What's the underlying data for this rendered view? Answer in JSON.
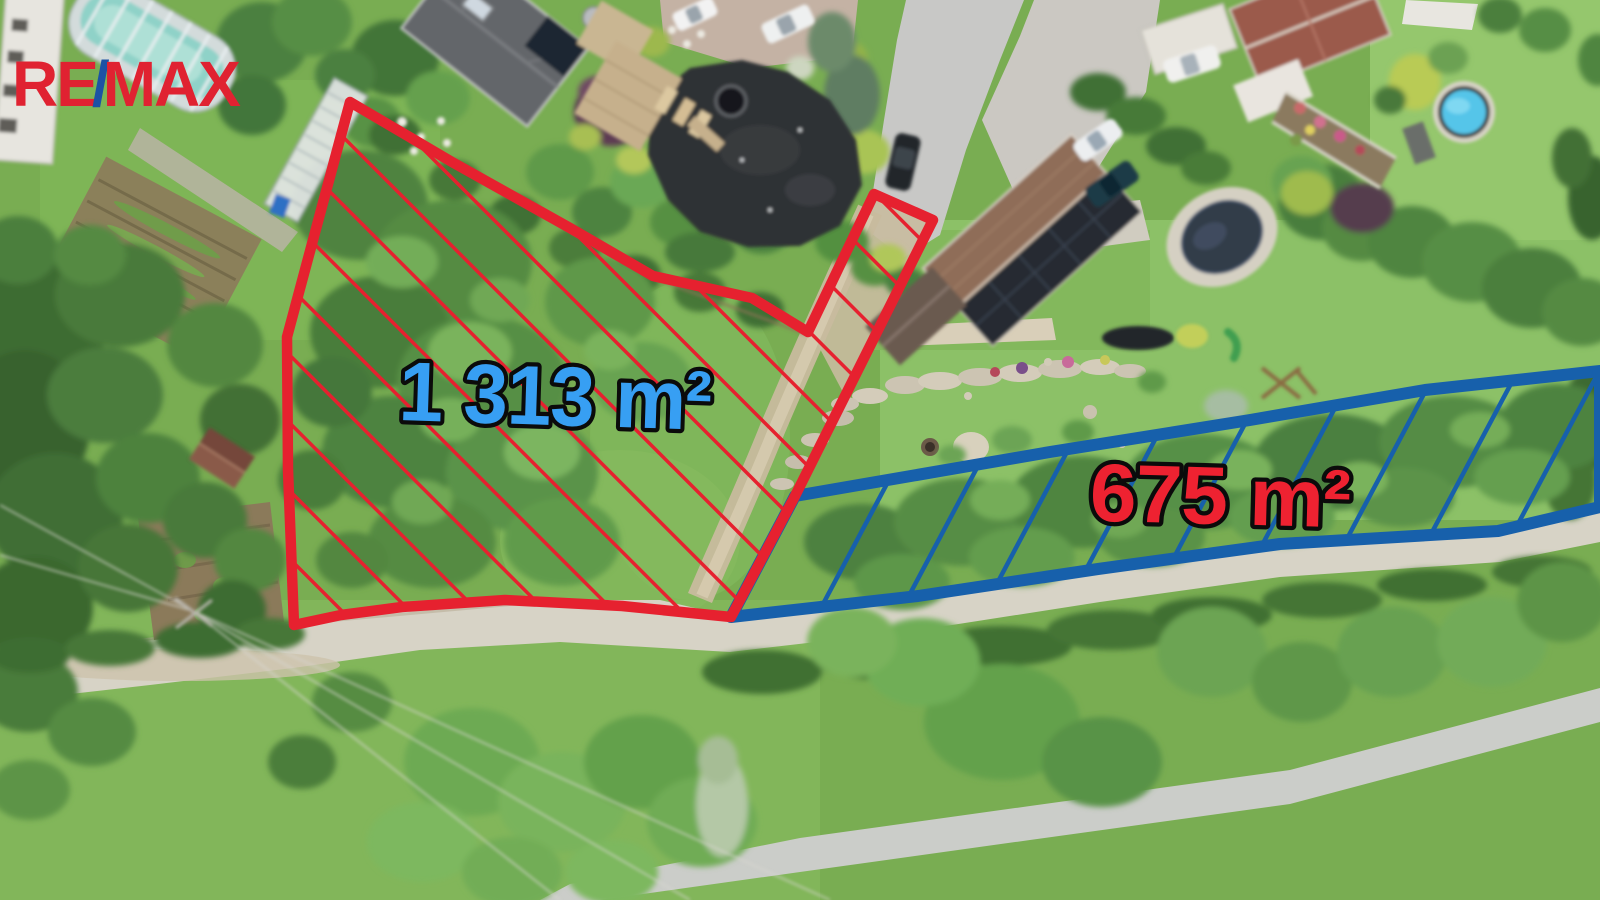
{
  "branding": {
    "re": "RE",
    "slash": "/",
    "max": "MAX",
    "red": "#e02231",
    "blue": "#1c52a5"
  },
  "plots": {
    "left": {
      "area_label": "1 313 m²",
      "outline_color": "#e6212f",
      "label_fill": "#379ff3"
    },
    "right": {
      "area_label": "675 m²",
      "outline_color": "#1760ab",
      "label_fill": "#ee2231"
    }
  }
}
